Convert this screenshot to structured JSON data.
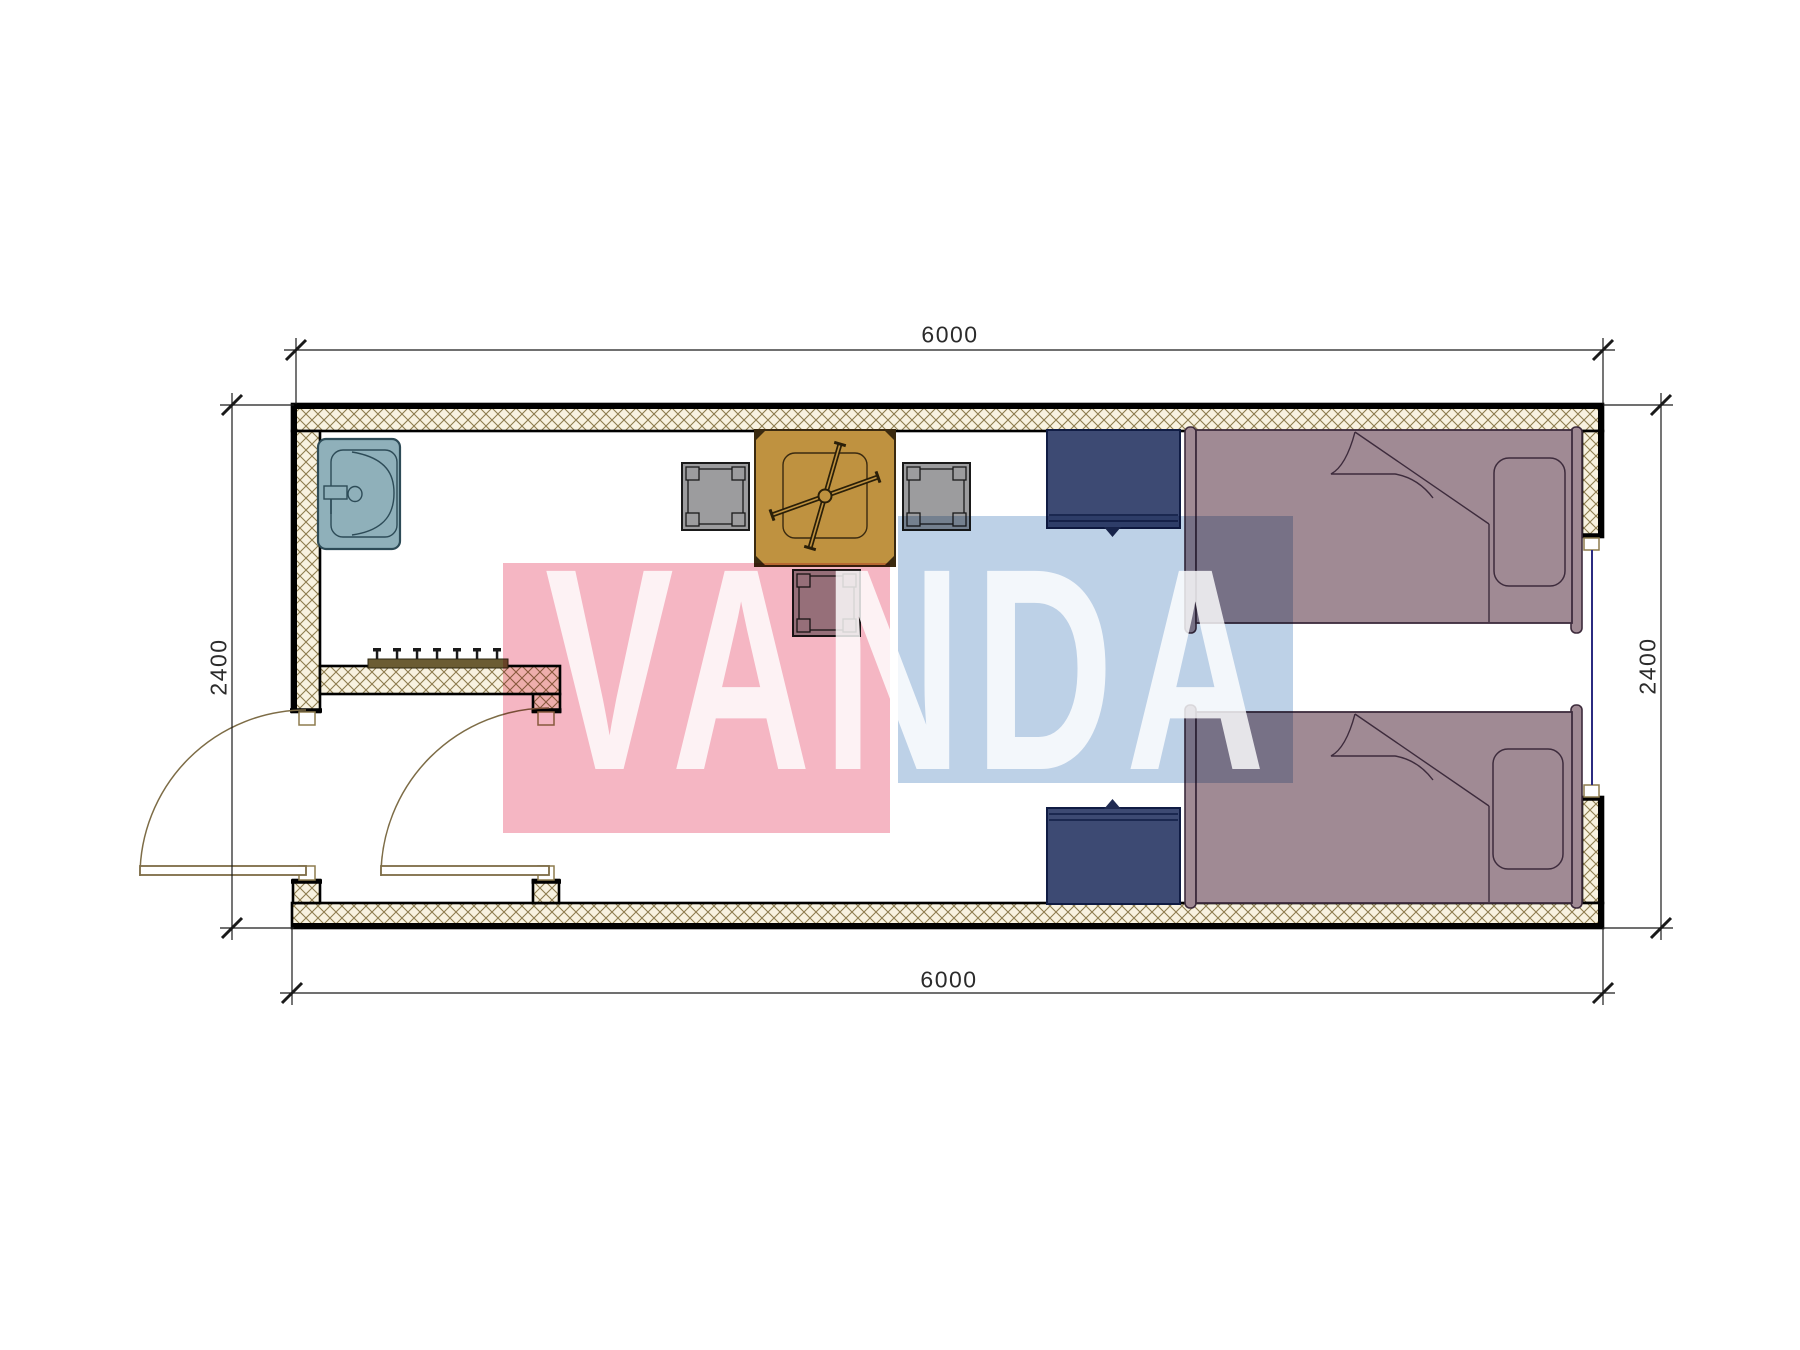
{
  "watermark": {
    "text": "VANDA",
    "pink_hex": "#f5b6c3",
    "blue_hex": "#bdd1e7"
  },
  "dimensions": {
    "top": "6000",
    "bottom": "6000",
    "left": "2400",
    "right": "2400"
  },
  "palette": {
    "wall_hatch_line": "#8d7c4e",
    "wall_hatch_bg": "#f8f2e0",
    "wall_outline": "#000000",
    "door_swing": "#7d6c46",
    "sink_fill": "#8fb0ba",
    "sink_outline": "#2d4b57",
    "table_fill": "#bf9240",
    "stool_fill": "#9c9c9e",
    "nightstand_fill": "#3d4a73",
    "bed_fill": "#a08a94",
    "bed_outline": "#3d2b3c",
    "window_glazing": "#2b2b80",
    "coat_rack_bar": "#6b5c33"
  },
  "furniture": [
    {
      "name": "sink"
    },
    {
      "name": "coat-rack"
    },
    {
      "name": "dining-table"
    },
    {
      "name": "stool-left"
    },
    {
      "name": "stool-right"
    },
    {
      "name": "stool-bottom"
    },
    {
      "name": "nightstand-top"
    },
    {
      "name": "nightstand-bottom"
    },
    {
      "name": "bed-top"
    },
    {
      "name": "bed-bottom"
    }
  ]
}
